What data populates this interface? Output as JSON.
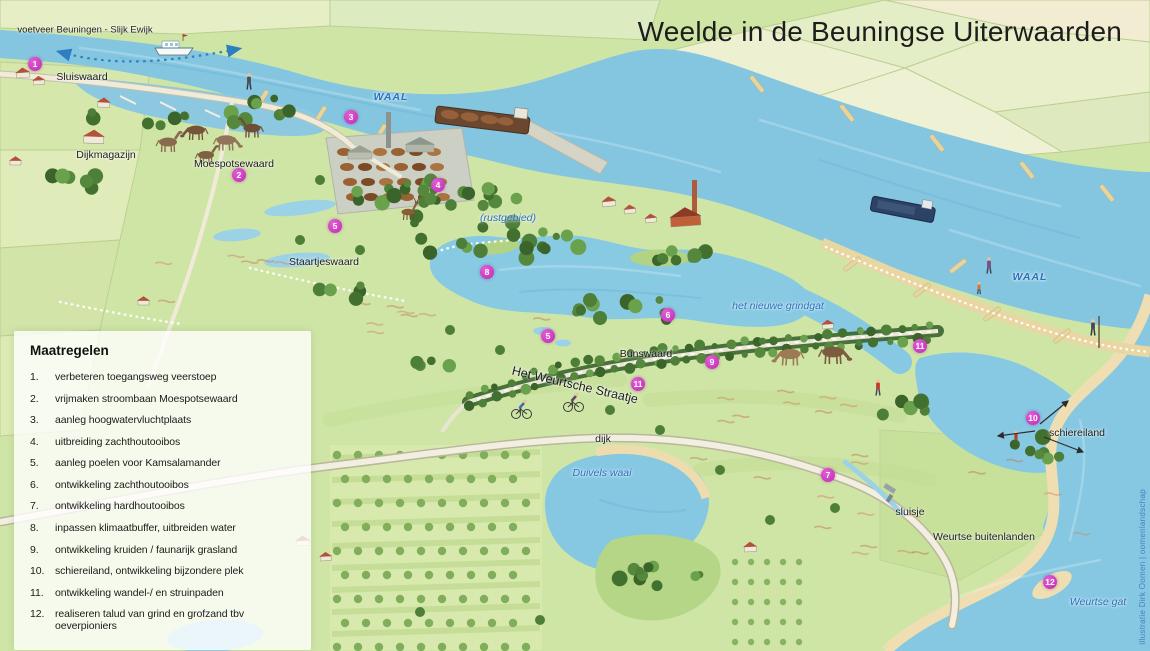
{
  "title": "Weelde in de Beuningse Uiterwaarden",
  "credit": "illustratie Dirk Oomen | oomenlandschap",
  "legend": {
    "title": "Maatregelen",
    "items": [
      {
        "num": "1.",
        "text": "verbeteren toegangsweg veerstoep"
      },
      {
        "num": "2.",
        "text": "vrijmaken stroombaan Moespotsewaard"
      },
      {
        "num": "3.",
        "text": "aanleg hoogwatervluchtplaats"
      },
      {
        "num": "4.",
        "text": "uitbreiding zachthoutooibos"
      },
      {
        "num": "5.",
        "text": "aanleg poelen voor Kamsalamander"
      },
      {
        "num": "6.",
        "text": "ontwikkeling zachthoutooibos"
      },
      {
        "num": "7.",
        "text": "ontwikkeling hardhoutooibos"
      },
      {
        "num": "8.",
        "text": "inpassen klimaatbuffer, uitbreiden water"
      },
      {
        "num": "9.",
        "text": "ontwikkeling kruiden / faunarijk grasland"
      },
      {
        "num": "10.",
        "text": "schiereiland, ontwikkeling bijzondere plek"
      },
      {
        "num": "11.",
        "text": "ontwikkeling wandel-/ en struinpaden"
      },
      {
        "num": "12.",
        "text": "realiseren talud van grind en grofzand tbv oeverpioniers"
      }
    ]
  },
  "map": {
    "labels": [
      {
        "text": "voetveer Beuningen - Slijk Ewijk",
        "x": 85,
        "y": 30,
        "cls": "place",
        "size": 9.5
      },
      {
        "text": "Sluiswaard",
        "x": 82,
        "y": 77,
        "cls": "place"
      },
      {
        "text": "Dijkmagazijn",
        "x": 106,
        "y": 155,
        "cls": "place"
      },
      {
        "text": "Moespotsewaard",
        "x": 234,
        "y": 164,
        "cls": "place"
      },
      {
        "text": "Staartjeswaard",
        "x": 324,
        "y": 262,
        "cls": "place"
      },
      {
        "text": "Bunswaard",
        "x": 646,
        "y": 354,
        "cls": "place"
      },
      {
        "text": "Het Weurtsche Straatje",
        "x": 575,
        "y": 385,
        "cls": "place lane",
        "rot": 13
      },
      {
        "text": "dijk",
        "x": 603,
        "y": 439,
        "cls": "place"
      },
      {
        "text": "sluisje",
        "x": 910,
        "y": 512,
        "cls": "place"
      },
      {
        "text": "Weurtse buitenlanden",
        "x": 984,
        "y": 537,
        "cls": "place"
      },
      {
        "text": "schiereiland",
        "x": 1077,
        "y": 433,
        "cls": "place"
      },
      {
        "text": "WAAL",
        "x": 391,
        "y": 97,
        "cls": "waterbig"
      },
      {
        "text": "(rustgebied)",
        "x": 508,
        "y": 218,
        "cls": "water"
      },
      {
        "text": "het nieuwe grindgat",
        "x": 778,
        "y": 306,
        "cls": "water"
      },
      {
        "text": "Duivels waai",
        "x": 602,
        "y": 473,
        "cls": "water"
      },
      {
        "text": "WAAL",
        "x": 1030,
        "y": 277,
        "cls": "waterbig"
      },
      {
        "text": "Weurtse gat",
        "x": 1098,
        "y": 602,
        "cls": "water"
      }
    ],
    "markers": [
      {
        "num": "1",
        "x": 35,
        "y": 64
      },
      {
        "num": "2",
        "x": 239,
        "y": 175
      },
      {
        "num": "3",
        "x": 351,
        "y": 117
      },
      {
        "num": "4",
        "x": 438,
        "y": 185
      },
      {
        "num": "5",
        "x": 335,
        "y": 226
      },
      {
        "num": "8",
        "x": 487,
        "y": 272
      },
      {
        "num": "5",
        "x": 548,
        "y": 336
      },
      {
        "num": "6",
        "x": 668,
        "y": 315
      },
      {
        "num": "9",
        "x": 712,
        "y": 362
      },
      {
        "num": "11",
        "x": 638,
        "y": 384
      },
      {
        "num": "11",
        "x": 920,
        "y": 346
      },
      {
        "num": "7",
        "x": 828,
        "y": 475
      },
      {
        "num": "10",
        "x": 1033,
        "y": 418
      },
      {
        "num": "12",
        "x": 1050,
        "y": 582
      }
    ],
    "colors": {
      "water": "#85c6e0",
      "land": "#cfe5a6",
      "sand": "#e8d7a2",
      "marker": "#bf2ab3",
      "water_label": "#2a6fbe"
    }
  }
}
